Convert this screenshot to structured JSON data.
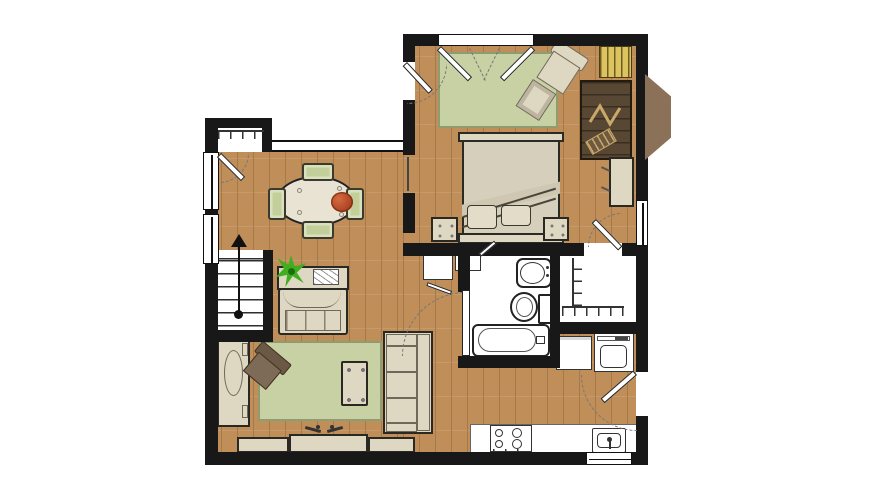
{
  "palette": {
    "wall": "#181818",
    "wood": "#bf8e59",
    "woodline": "#a6794a",
    "rug": "#c8d1a3",
    "rugb": "#8f9c71",
    "cream": "#ded7c1",
    "ink": "#2a2822",
    "dark": "#75624e",
    "desk": "#584732",
    "bay": "#8a7158",
    "yellow": "#dcc35f",
    "plant": "#3fae1f",
    "flower": "#bf4f2e",
    "green": "#c3cf9b",
    "white": "#ffffff",
    "dash": "#777777",
    "fix": "#333333"
  },
  "floor_plan": {
    "kind": "one-bedroom apartment floor plan, top-down color rendering, no text labels",
    "rooms": [
      {
        "name": "bedroom",
        "position": "top-right",
        "items": [
          "double closet doors on top wall",
          "green area rug",
          "upholstered armchair with ottoman",
          "bed with headboard and footboard, two pillows, folded blanket",
          "two nightstands",
          "yellow book storage",
          "dark wood desk at bay window",
          "small writing desk on right wall",
          "door to walk-in closet"
        ]
      },
      {
        "name": "dining-area",
        "position": "center-left",
        "items": [
          "oval dining table",
          "four green dining chairs",
          "red flower centerpiece",
          "entry coat closet with hanging rod",
          "window band on top wall",
          "up-arrow stair direction marker"
        ]
      },
      {
        "name": "living-room",
        "position": "bottom-left",
        "items": [
          "console table with potted plant",
          "loveseat",
          "green area rug",
          "dark accent chair",
          "coffee table",
          "three-seat sofa",
          "media console with TV",
          "tall storage cabinet on left wall"
        ]
      },
      {
        "name": "bathroom",
        "position": "center-right",
        "items": [
          "vanity sink",
          "toilet",
          "bathtub",
          "door opening to hall"
        ]
      },
      {
        "name": "walk-in-closet",
        "position": "right",
        "items": [
          "L-shaped hanging rod with hangers"
        ]
      },
      {
        "name": "laundry",
        "position": "right",
        "items": [
          "washer",
          "dryer"
        ]
      },
      {
        "name": "kitchen",
        "position": "bottom-right",
        "items": [
          "counter run",
          "four-burner range",
          "kitchen sink",
          "window behind sink",
          "apartment entry door"
        ]
      },
      {
        "name": "stairs",
        "position": "left",
        "items": [
          "staircase with railing, five treads and direction arrow"
        ]
      },
      {
        "name": "hall",
        "position": "center",
        "items": [
          "two built-in linen cabinets"
        ]
      }
    ]
  }
}
